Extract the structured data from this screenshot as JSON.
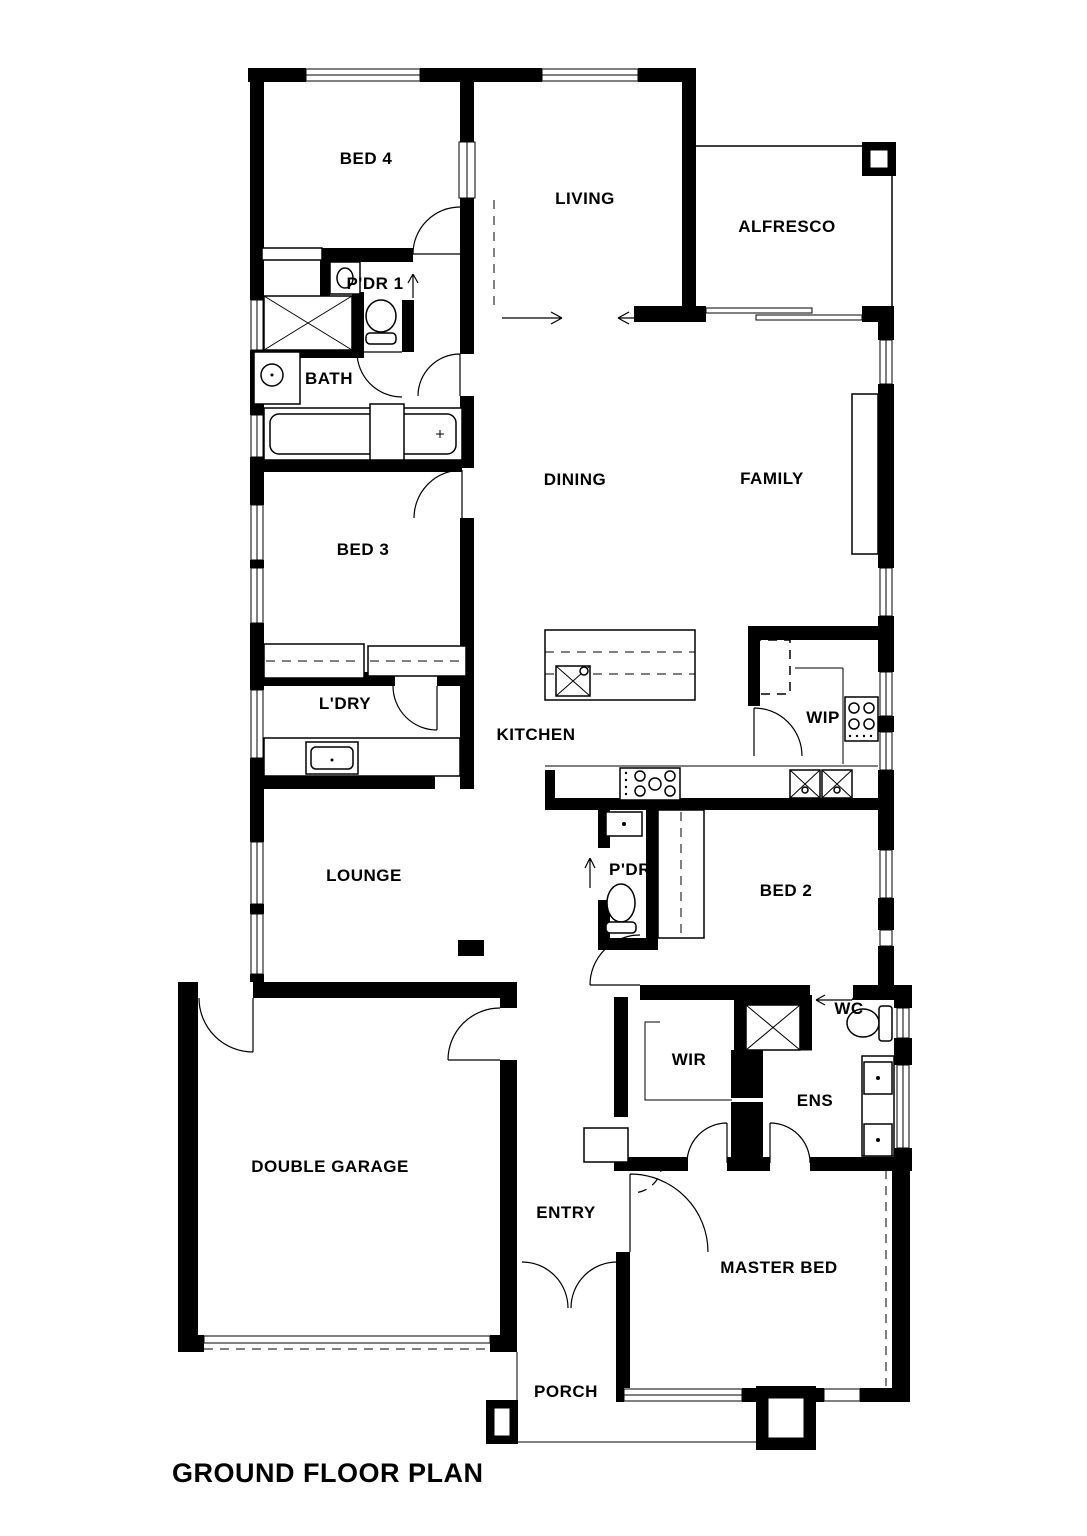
{
  "title": "GROUND FLOOR PLAN",
  "colors": {
    "walls": "#000000",
    "background": "#ffffff",
    "linework": "#000000"
  },
  "rooms": [
    {
      "id": "bed4",
      "label": "BED 4"
    },
    {
      "id": "living",
      "label": "LIVING"
    },
    {
      "id": "alfresco",
      "label": "ALFRESCO"
    },
    {
      "id": "pdr1",
      "label": "P'DR 1"
    },
    {
      "id": "bath",
      "label": "BATH"
    },
    {
      "id": "dining",
      "label": "DINING"
    },
    {
      "id": "family",
      "label": "FAMILY"
    },
    {
      "id": "bed3",
      "label": "BED 3"
    },
    {
      "id": "ldry",
      "label": "L'DRY"
    },
    {
      "id": "kitchen",
      "label": "KITCHEN"
    },
    {
      "id": "wip",
      "label": "WIP"
    },
    {
      "id": "lounge",
      "label": "LOUNGE"
    },
    {
      "id": "pdr",
      "label": "P'DR"
    },
    {
      "id": "bed2",
      "label": "BED 2"
    },
    {
      "id": "wc",
      "label": "WC"
    },
    {
      "id": "wir",
      "label": "WIR"
    },
    {
      "id": "ens",
      "label": "ENS"
    },
    {
      "id": "garage",
      "label": "DOUBLE GARAGE"
    },
    {
      "id": "entry",
      "label": "ENTRY"
    },
    {
      "id": "master",
      "label": "MASTER BED"
    },
    {
      "id": "porch",
      "label": "PORCH"
    }
  ],
  "fixtures": [
    "toilet-icon",
    "basin-icon",
    "double-sink-icon",
    "island-sink-icon",
    "cooktop-icon",
    "pantry-cooktop-icon",
    "bathtub-icon",
    "shower-icon",
    "laundry-trough-icon",
    "fridge-space-icon",
    "wardrobe-icon",
    "window-icon",
    "door-swing-icon",
    "sliding-door-arrow-icon",
    "garage-door-icon",
    "pillar-icon"
  ]
}
